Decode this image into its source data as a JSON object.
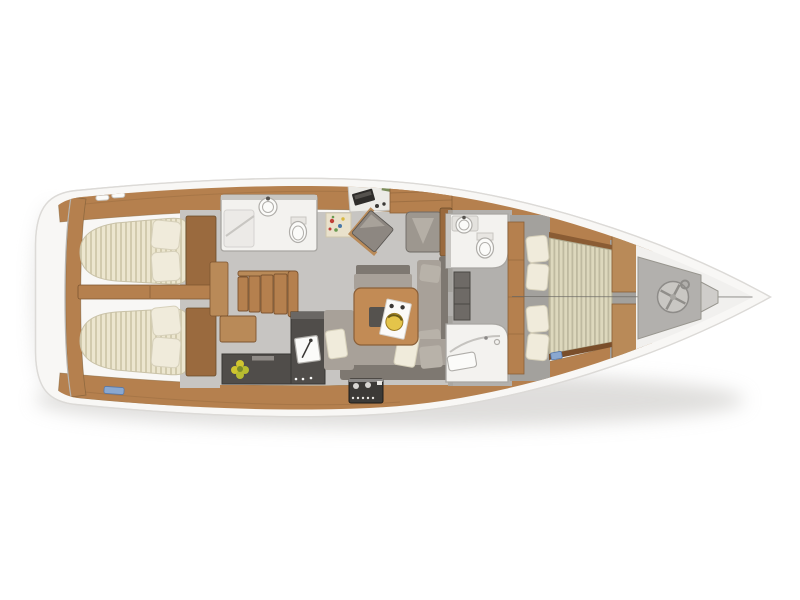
{
  "meta": {
    "type": "yacht-interior-floor-plan",
    "view": "top-down",
    "orientation": "bow-right",
    "visible_text": ""
  },
  "colors": {
    "bg": "#ffffff",
    "hull": "#f8f7f5",
    "hullEdge": "#dcdad7",
    "shadow": "#c5c3c0",
    "deckWood": "#b5804e",
    "furnitureWood": "#b98a58",
    "furnitureWoodDark": "#9a6a3e",
    "woodSeam": "#8a5f38",
    "floorSaloon": "#c7c5c2",
    "floorPassage": "#b2b0ad",
    "floorFore": "#a3a19d",
    "roomWhite": "#f3f2ef",
    "wallGray": "#a8a6a2",
    "fixtureWhite": "#fbfbf9",
    "fixtureStroke": "#b0aeaa",
    "sofaSeat": "#a8a199",
    "sofaBack": "#7e7871",
    "cushion": "#b8b2a9",
    "pillowWhite": "#f0ebdb",
    "pillowStroke": "#d6d0ba",
    "aftBedBase": "#ece6cf",
    "aftBedStripe": "#d2cbae",
    "foreBedBase": "#ddd8bd",
    "foreBedStripe": "#bfbaa0",
    "tableWood": "#c28b55",
    "tableInset": "#55524e",
    "counter": "#504d4a",
    "counterDark": "#393734",
    "appliance": "#3c3a37",
    "magazine": "#fbfaf8",
    "plateYellow": "#e4c44a",
    "flowerYellow": "#cfc52f",
    "flowerGreen": "#7a8a2a",
    "rugBase": "#e9e1cb",
    "accentRed": "#c04038",
    "accentBlue": "#4878a8",
    "accentGreen": "#6a9a50",
    "accentYellow": "#d8b840",
    "windowBlue": "#8aa8d0",
    "bowDeck": "#f1f0ee",
    "lockerGray": "#b2b0ad",
    "metal": "#c9c7c3",
    "metalStroke": "#8e8c89",
    "laptop": "#2e2c2a"
  },
  "features": [
    {
      "name": "hull",
      "desc": "white yacht hull, bow pointing right"
    },
    {
      "name": "stern-transom",
      "desc": "rounded stern with wood trim crescent"
    },
    {
      "name": "aft-cabin-port",
      "desc": "aft double cabin, striped berth, two pillows"
    },
    {
      "name": "aft-cabin-starboard",
      "desc": "aft double cabin, striped berth, two pillows"
    },
    {
      "name": "aft-heads",
      "desc": "aft bathroom with shower, round basin and toilet"
    },
    {
      "name": "companionway-stairs",
      "desc": "wooden steps down into saloon"
    },
    {
      "name": "saloon",
      "desc": "main salon with light gray floor"
    },
    {
      "name": "nav-station",
      "desc": "chart table with laptop and rotated navigator seat"
    },
    {
      "name": "rug",
      "desc": "small multicolour floral rug"
    },
    {
      "name": "side-seat",
      "desc": "gray seat with wooden backrest"
    },
    {
      "name": "u-sofa",
      "desc": "U-shaped taupe settee with pillows"
    },
    {
      "name": "saloon-table",
      "desc": "square wooden table with dark inset and magazine with plate"
    },
    {
      "name": "galley",
      "desc": "L-shaped dark galley counter with sink, flower decor and stove"
    },
    {
      "name": "forward-heads",
      "desc": "forward bathroom with basin and toilet"
    },
    {
      "name": "forward-shower",
      "desc": "separate shower cabin with curved glass"
    },
    {
      "name": "wardrobe",
      "desc": "dark wardrobe in forward passage"
    },
    {
      "name": "owners-cabin",
      "desc": "forward V-berth with striped mattress and four pillows"
    },
    {
      "name": "chain-locker",
      "desc": "gray anchor chain locker in bow"
    },
    {
      "name": "anchor-windlass",
      "desc": "round windlass drum with ring"
    },
    {
      "name": "cleat",
      "desc": "white deck cleat on side deck"
    },
    {
      "name": "hull-window",
      "desc": "small blue hull window"
    }
  ]
}
